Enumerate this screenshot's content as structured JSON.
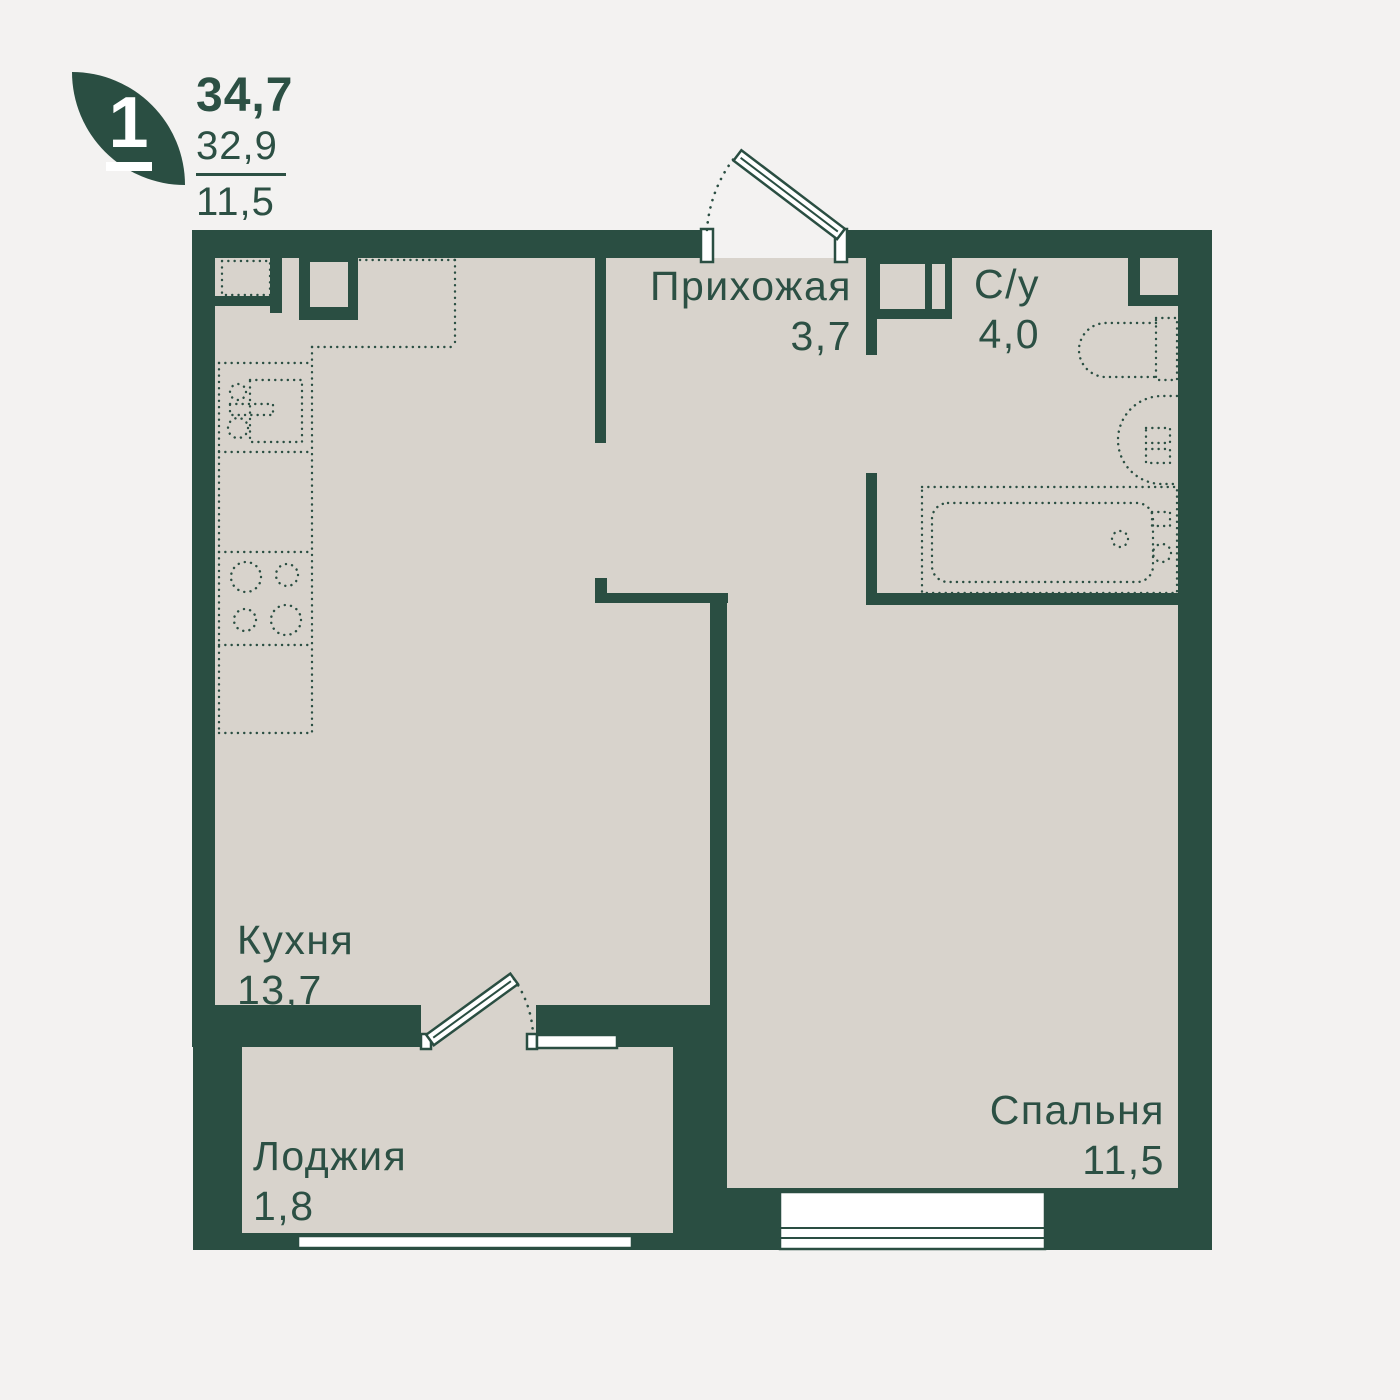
{
  "header": {
    "rooms_count": "1",
    "total_area": "34,7",
    "living_area": "32,9",
    "extra_area": "11,5"
  },
  "rooms": [
    {
      "name": "Прихожая",
      "area": "3,7"
    },
    {
      "name": "С/у",
      "area": "4,0"
    },
    {
      "name": "Кухня",
      "area": "13,7"
    },
    {
      "name": "Лоджия",
      "area": "1,8"
    },
    {
      "name": "Спальня",
      "area": "11,5"
    }
  ],
  "icons": {
    "logo": "leaf-icon"
  },
  "colors": {
    "wall": "#2A4E42",
    "floor": "#D8D3CC",
    "background": "#F3F2F1",
    "text": "#2C5044",
    "white": "#FFFFFF"
  }
}
